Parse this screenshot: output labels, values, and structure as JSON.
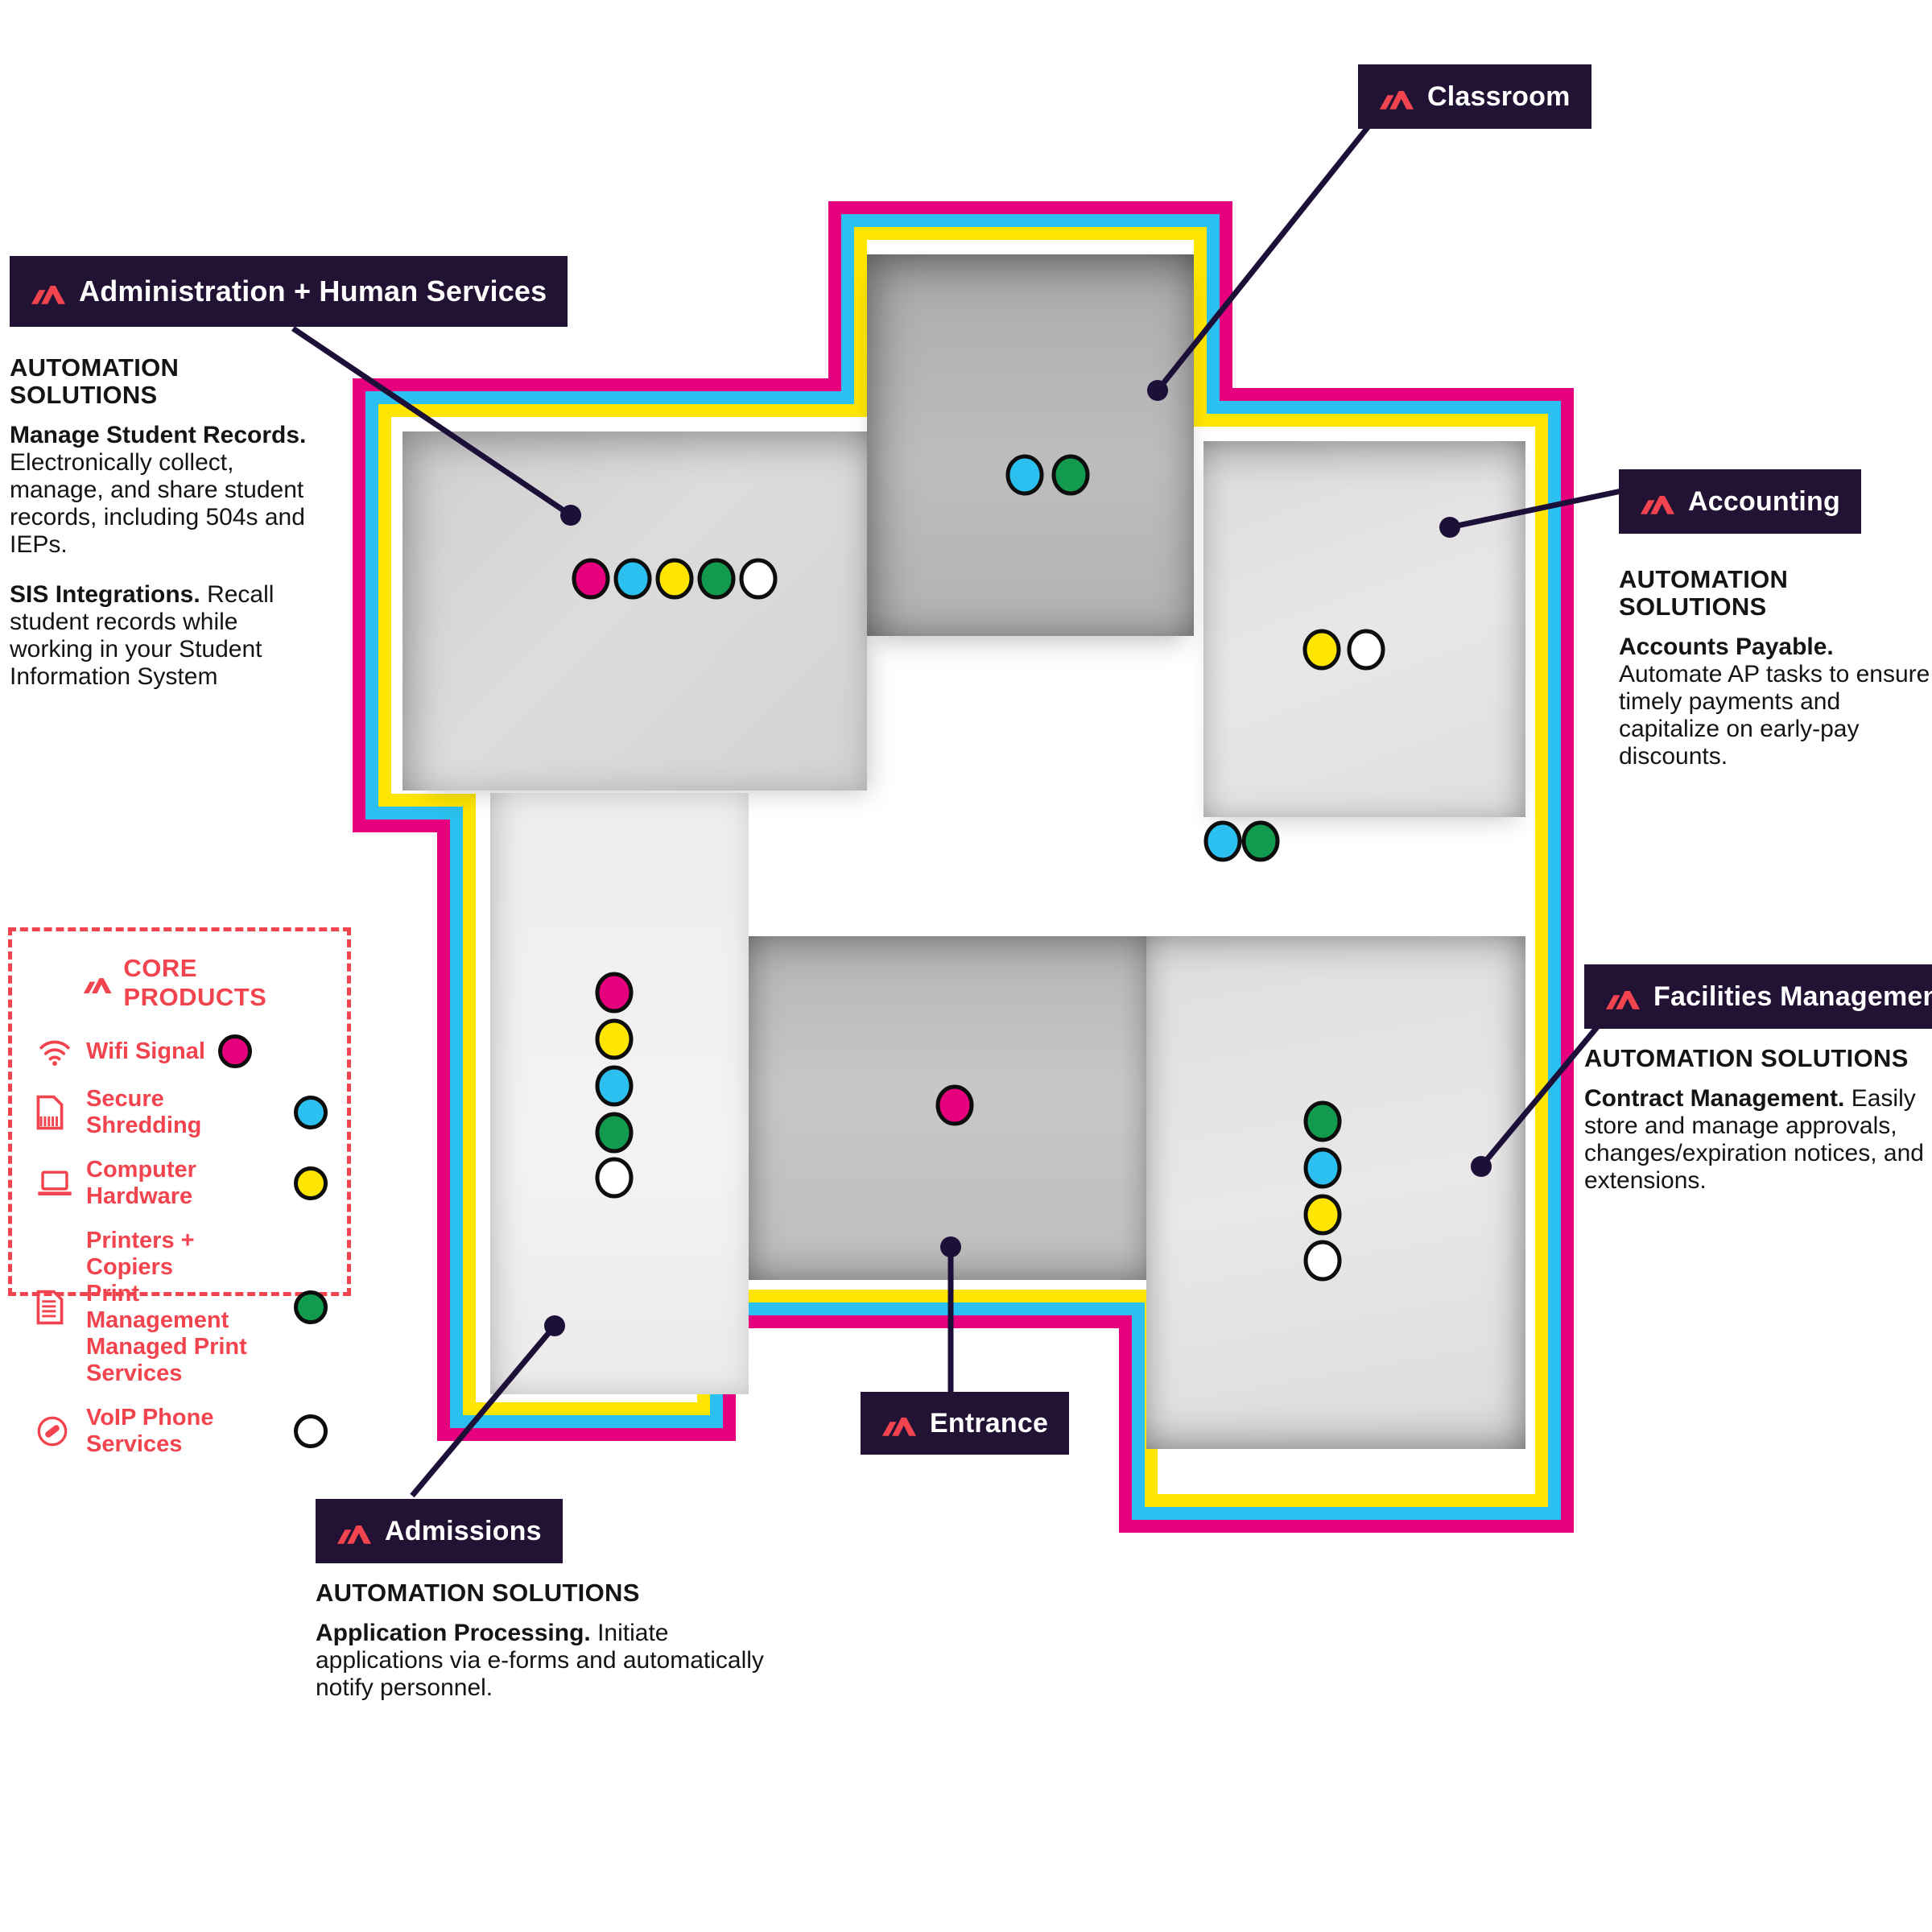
{
  "colors": {
    "magenta": "#E6007E",
    "cyan": "#2BC0EF",
    "yellow": "#FFE600",
    "green": "#129B4F",
    "white": "#FFFFFF",
    "label_background": "#221233",
    "brand_red": "#F2444E",
    "connector_line": "#1D1038"
  },
  "legend": {
    "title": "CORE PRODUCTS",
    "items": [
      {
        "icon": "wifi-icon",
        "label": "Wifi Signal",
        "dot": "magenta"
      },
      {
        "icon": "shredder-document-icon",
        "label": "Secure Shredding",
        "dot": "cyan"
      },
      {
        "icon": "laptop-icon",
        "label": "Computer Hardware",
        "dot": "yellow"
      },
      {
        "icon": "printer-document-icon",
        "label": "Printers + Copiers\nPrint Management\nManaged Print Services",
        "dot": "green"
      },
      {
        "icon": "voip-phone-icon",
        "label": "VoIP Phone Services",
        "dot": "white"
      }
    ]
  },
  "areas": {
    "administration": {
      "label": "Administration + Human Services",
      "heading": "AUTOMATION SOLUTIONS",
      "p1": {
        "lead": "Manage Student Records.",
        "text": "Electronically collect, manage, and share student records, including 504s and IEPs."
      },
      "p2": {
        "lead": "SIS Integrations.",
        "text": "Recall student records while working in your Student Information System"
      },
      "products": [
        "Wifi Signal",
        "Secure Shredding",
        "Computer Hardware",
        "Printers + Copiers",
        "VoIP Phone Services"
      ]
    },
    "classroom": {
      "label": "Classroom",
      "products": [
        "Secure Shredding",
        "Printers + Copiers"
      ]
    },
    "accounting": {
      "label": "Accounting",
      "heading": "AUTOMATION SOLUTIONS",
      "p1": {
        "lead": "Accounts Payable.",
        "text": "Automate AP tasks to ensure timely payments and capitalize on early-pay discounts."
      },
      "products": [
        "Computer Hardware",
        "VoIP Phone Services"
      ]
    },
    "facilities": {
      "label": "Facilities Management",
      "heading": "AUTOMATION SOLUTIONS",
      "p1": {
        "lead": "Contract Management.",
        "text": "Easily store and manage approvals, changes/expiration notices, and extensions."
      },
      "products": [
        "Printers + Copiers",
        "Secure Shredding",
        "Computer Hardware",
        "VoIP Phone Services"
      ]
    },
    "admissions": {
      "label": "Admissions",
      "heading": "AUTOMATION SOLUTIONS",
      "p1": {
        "lead": "Application Processing.",
        "text": "Initiate applications via e-forms and automatically notify personnel."
      },
      "products": [
        "Wifi Signal",
        "Computer Hardware",
        "Secure Shredding",
        "Printers + Copiers",
        "VoIP Phone Services"
      ]
    },
    "entrance": {
      "label": "Entrance",
      "products": [
        "Wifi Signal"
      ]
    },
    "hallway": {
      "products": [
        "Secure Shredding",
        "Printers + Copiers"
      ]
    }
  }
}
